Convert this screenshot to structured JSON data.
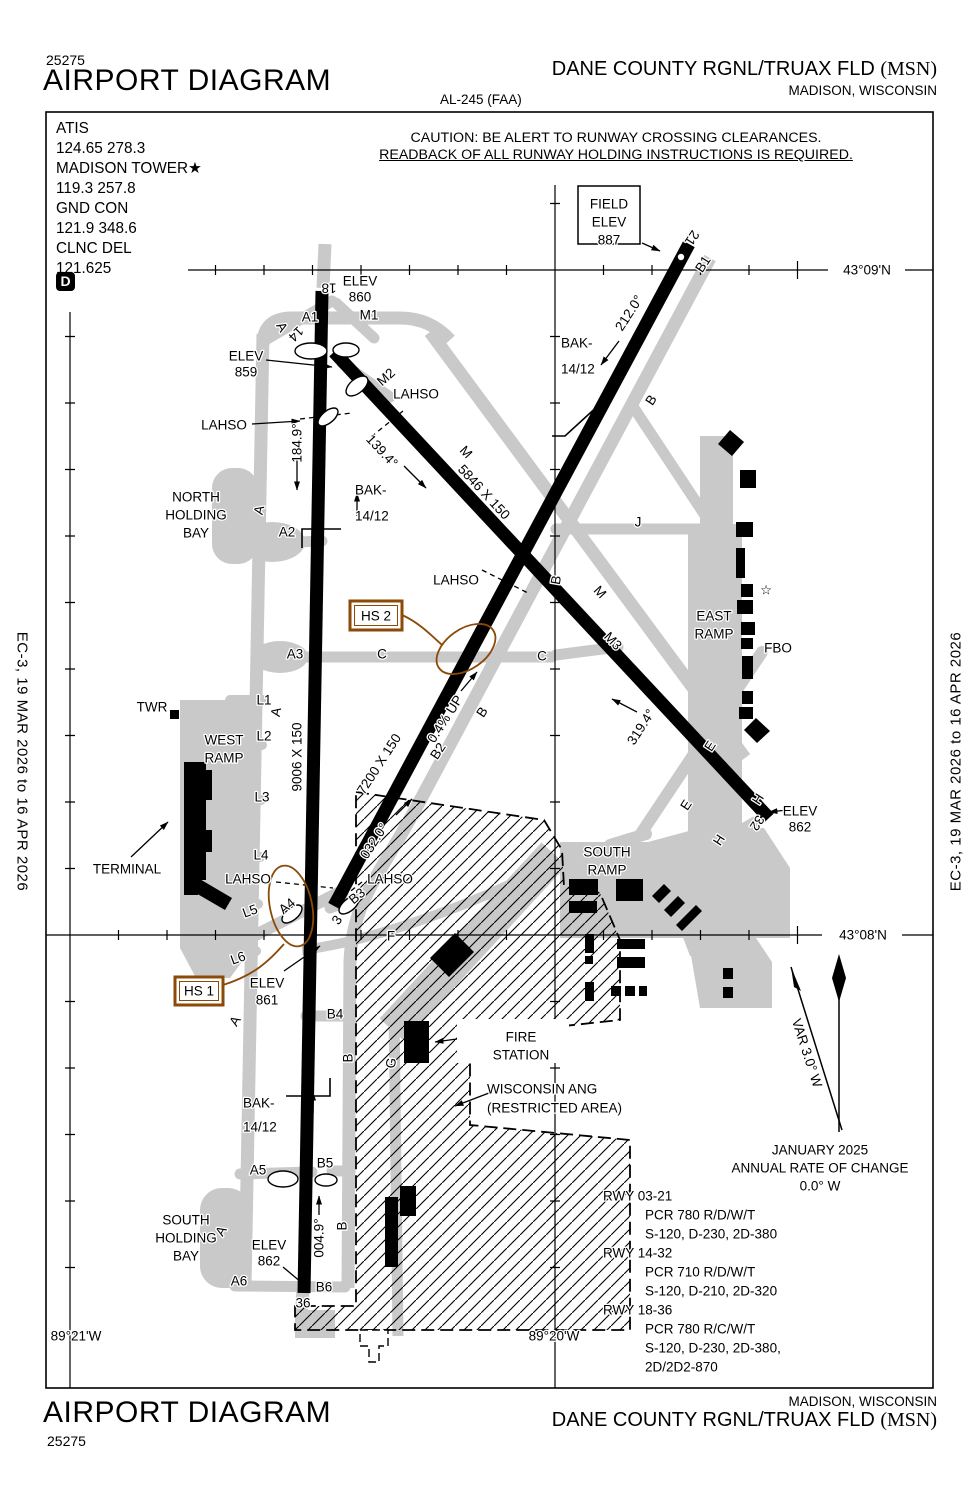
{
  "colors": {
    "hs": "#8b4a08",
    "taxiway": "#c9c9c9"
  },
  "header": {
    "chart_number": "25275",
    "title": "AIRPORT DIAGRAM",
    "chart_code": "AL-245 (FAA)",
    "airport_name": "DANE COUNTY RGNL/TRUAX FLD",
    "airport_ident": "(MSN)",
    "city": "MADISON, WISCONSIN"
  },
  "footer": {
    "chart_number": "25275",
    "title": "AIRPORT DIAGRAM",
    "airport_name": "DANE COUNTY RGNL/TRUAX FLD",
    "airport_ident": "(MSN)",
    "city": "MADISON, WISCONSIN"
  },
  "edge_note": "EC-3,  19 MAR 2026  to  16 APR 2026",
  "caution": {
    "line1": "CAUTION: BE ALERT TO RUNWAY CROSSING CLEARANCES.",
    "line2": "READBACK OF ALL RUNWAY HOLDING INSTRUCTIONS IS REQUIRED."
  },
  "comm": {
    "lines": [
      "ATIS",
      "124.65  278.3",
      "MADISON TOWER★",
      "119.3  257.8",
      "GND CON",
      "121.9  348.6",
      "CLNC DEL",
      "121.625"
    ],
    "d_symbol": "D"
  },
  "map_labels": [
    {
      "n": "field-elev-word1",
      "t": "FIELD",
      "x": 609,
      "y": 204,
      "s": 15
    },
    {
      "n": "field-elev-word2",
      "t": "ELEV",
      "x": 609,
      "y": 222,
      "s": 15
    },
    {
      "n": "field-elev-value",
      "t": "887",
      "x": 609,
      "y": 240,
      "s": 15
    },
    {
      "n": "lat-label-0909",
      "t": "43°09'N",
      "x": 867,
      "y": 270,
      "s": 15
    },
    {
      "n": "lat-label-0908",
      "t": "43°08'N",
      "x": 863,
      "y": 935,
      "s": 15
    },
    {
      "n": "lon-label-8921",
      "t": "89°21'W",
      "x": 76,
      "y": 1336,
      "s": 15
    },
    {
      "n": "lon-label-8920",
      "t": "89°20'W",
      "x": 554,
      "y": 1336,
      "s": 15
    },
    {
      "n": "rwy18-number",
      "t": "18",
      "x": 329,
      "y": 288,
      "r": 180,
      "s": 14
    },
    {
      "n": "elev-860-word",
      "t": "ELEV",
      "x": 360,
      "y": 281
    },
    {
      "n": "elev-860-value",
      "t": "860",
      "x": 360,
      "y": 297
    },
    {
      "n": "twy-a1",
      "t": "A1",
      "x": 310,
      "y": 317
    },
    {
      "n": "twy-m1",
      "t": "M1",
      "x": 369,
      "y": 315
    },
    {
      "n": "twy-a-letter-1",
      "t": "A",
      "x": 282,
      "y": 327,
      "r": 60,
      "s": 12.5
    },
    {
      "n": "rwy14-number",
      "t": "14",
      "x": 296,
      "y": 334,
      "r": 135,
      "s": 14
    },
    {
      "n": "elev-859-word",
      "t": "ELEV",
      "x": 246,
      "y": 356
    },
    {
      "n": "elev-859-value",
      "t": "859",
      "x": 246,
      "y": 372
    },
    {
      "n": "twy-m2",
      "t": "M2",
      "x": 386,
      "y": 377,
      "r": -42
    },
    {
      "n": "lahso-1",
      "t": "LAHSO",
      "x": 416,
      "y": 394
    },
    {
      "n": "lahso-2",
      "t": "LAHSO",
      "x": 224,
      "y": 425
    },
    {
      "n": "hdg-184",
      "t": "184.9°",
      "x": 297,
      "y": 443,
      "r": -90
    },
    {
      "n": "bak-n1a",
      "t": "BAK-",
      "x": 355,
      "y": 490,
      "a": "s"
    },
    {
      "n": "bak-n1b",
      "t": "14/12",
      "x": 355,
      "y": 516,
      "a": "s"
    },
    {
      "n": "dim-5846",
      "t": "5846 X 150",
      "x": 484,
      "y": 492,
      "r": 47
    },
    {
      "n": "hdg-139",
      "t": "139.4°",
      "x": 382,
      "y": 451,
      "r": 47
    },
    {
      "n": "twy-m-letter-1",
      "t": "M",
      "x": 466,
      "y": 452,
      "r": 47
    },
    {
      "n": "twy-m-letter-2",
      "t": "M",
      "x": 600,
      "y": 592,
      "r": 47
    },
    {
      "n": "twy-m3",
      "t": "M3",
      "x": 613,
      "y": 641,
      "r": 47
    },
    {
      "n": "bak-n2a",
      "t": "BAK-",
      "x": 561,
      "y": 343,
      "a": "s"
    },
    {
      "n": "bak-n2b",
      "t": "14/12",
      "x": 561,
      "y": 369,
      "a": "s"
    },
    {
      "n": "hdg-212",
      "t": "212.0°",
      "x": 629,
      "y": 313,
      "r": -57
    },
    {
      "n": "twy-b-letter-1",
      "t": "B",
      "x": 651,
      "y": 400,
      "r": -57
    },
    {
      "n": "twy-b1",
      "t": "B1",
      "x": 703,
      "y": 264,
      "r": -57
    },
    {
      "n": "rwy21-number",
      "t": "21",
      "x": 692,
      "y": 238,
      "r": 123,
      "s": 14
    },
    {
      "n": "north-holding-1",
      "t": "NORTH",
      "x": 196,
      "y": 497
    },
    {
      "n": "north-holding-2",
      "t": "HOLDING",
      "x": 196,
      "y": 515
    },
    {
      "n": "north-holding-3",
      "t": "BAY",
      "x": 196,
      "y": 533
    },
    {
      "n": "twy-a-letter-2",
      "t": "A",
      "x": 259,
      "y": 510,
      "r": -78,
      "s": 12.5
    },
    {
      "n": "twy-a2",
      "t": "A2",
      "x": 287,
      "y": 532
    },
    {
      "n": "hs2-label",
      "t": "HS 2",
      "x": 376,
      "y": 616,
      "c": "hs",
      "s": 14.5
    },
    {
      "n": "twy-a3",
      "t": "A3",
      "x": 295,
      "y": 654
    },
    {
      "n": "twy-c-letter-1",
      "t": "C",
      "x": 382,
      "y": 654
    },
    {
      "n": "twy-c-letter-2",
      "t": "C",
      "x": 542,
      "y": 656
    },
    {
      "n": "lahso-3",
      "t": "LAHSO",
      "x": 456,
      "y": 580
    },
    {
      "n": "twy-b-letter-2",
      "t": "B",
      "x": 556,
      "y": 580,
      "r": -80
    },
    {
      "n": "twy-j",
      "t": "J",
      "x": 638,
      "y": 522
    },
    {
      "n": "east-ramp-1",
      "t": "EAST",
      "x": 714,
      "y": 616,
      "s": 14.5
    },
    {
      "n": "east-ramp-2",
      "t": "RAMP",
      "x": 714,
      "y": 634,
      "s": 14.5
    },
    {
      "n": "beacon-star-icon",
      "t": "☆",
      "x": 766,
      "y": 590,
      "s": 18
    },
    {
      "n": "fbo-label",
      "t": "FBO",
      "x": 778,
      "y": 648,
      "s": 14.5
    },
    {
      "n": "twr-label",
      "t": "TWR",
      "x": 152,
      "y": 707
    },
    {
      "n": "west-ramp-1",
      "t": "WEST",
      "x": 224,
      "y": 740,
      "s": 14.5
    },
    {
      "n": "west-ramp-2",
      "t": "RAMP",
      "x": 224,
      "y": 758,
      "s": 14.5
    },
    {
      "n": "twy-l1",
      "t": "L1",
      "x": 264,
      "y": 700
    },
    {
      "n": "twy-a-letter-3",
      "t": "A",
      "x": 276,
      "y": 712,
      "r": -80,
      "s": 12.5
    },
    {
      "n": "twy-l2",
      "t": "L2",
      "x": 264,
      "y": 736
    },
    {
      "n": "twy-l3",
      "t": "L3",
      "x": 262,
      "y": 797
    },
    {
      "n": "twy-l4",
      "t": "L4",
      "x": 261,
      "y": 855
    },
    {
      "n": "twy-l5",
      "t": "L5",
      "x": 250,
      "y": 911,
      "r": -20
    },
    {
      "n": "twy-l6",
      "t": "L6",
      "x": 238,
      "y": 958,
      "r": -20
    },
    {
      "n": "dim-9006",
      "t": "9006 X 150",
      "x": 297,
      "y": 757,
      "r": -90
    },
    {
      "n": "dim-7200",
      "t": "7200 X 150",
      "x": 379,
      "y": 764,
      "r": -57
    },
    {
      "n": "hdg-032",
      "t": "032.0°",
      "x": 374,
      "y": 841,
      "r": -57
    },
    {
      "n": "grade-note",
      "t": "0.4% UP",
      "x": 445,
      "y": 719,
      "r": -57
    },
    {
      "n": "twy-b-letter-3",
      "t": "B",
      "x": 482,
      "y": 712,
      "r": -57
    },
    {
      "n": "twy-b2",
      "t": "B2",
      "x": 438,
      "y": 751,
      "r": -57
    },
    {
      "n": "hdg-319",
      "t": "319.4°",
      "x": 641,
      "y": 727,
      "r": -57
    },
    {
      "n": "twy-e-letter-1",
      "t": "E",
      "x": 710,
      "y": 746,
      "r": -57
    },
    {
      "n": "twy-e-letter-2",
      "t": "E",
      "x": 686,
      "y": 805,
      "r": -57
    },
    {
      "n": "twy-h-letter-1",
      "t": "H",
      "x": 758,
      "y": 799,
      "r": -57
    },
    {
      "n": "twy-h-letter-2",
      "t": "H",
      "x": 719,
      "y": 840,
      "r": -57
    },
    {
      "n": "rwy32-number",
      "t": "32",
      "x": 757,
      "y": 823,
      "r": 123,
      "s": 14
    },
    {
      "n": "elev-862-word",
      "t": "ELEV",
      "x": 800,
      "y": 811
    },
    {
      "n": "elev-862-value",
      "t": "862",
      "x": 800,
      "y": 827
    },
    {
      "n": "terminal-label",
      "t": "TERMINAL",
      "x": 127,
      "y": 869
    },
    {
      "n": "lahso-4",
      "t": "LAHSO",
      "x": 248,
      "y": 879
    },
    {
      "n": "lahso-5",
      "t": "LAHSO",
      "x": 390,
      "y": 879
    },
    {
      "n": "twy-a4",
      "t": "A4",
      "x": 287,
      "y": 906,
      "r": -40
    },
    {
      "n": "twy-b3",
      "t": "B3",
      "x": 357,
      "y": 896,
      "r": -40
    },
    {
      "n": "rwy3-number",
      "t": "3",
      "x": 337,
      "y": 920,
      "r": -55,
      "s": 14
    },
    {
      "n": "twy-f",
      "t": "F",
      "x": 391,
      "y": 936
    },
    {
      "n": "south-ramp-1",
      "t": "SOUTH",
      "x": 607,
      "y": 852,
      "s": 14.5
    },
    {
      "n": "south-ramp-2",
      "t": "RAMP",
      "x": 607,
      "y": 870,
      "s": 14.5
    },
    {
      "n": "hs1-label",
      "t": "HS 1",
      "x": 199,
      "y": 991,
      "c": "hs",
      "s": 14.5
    },
    {
      "n": "elev-861-word",
      "t": "ELEV",
      "x": 267,
      "y": 983
    },
    {
      "n": "elev-861-value",
      "t": "861",
      "x": 267,
      "y": 1000
    },
    {
      "n": "twy-b4",
      "t": "B4",
      "x": 335,
      "y": 1014
    },
    {
      "n": "twy-a-letter-4",
      "t": "A",
      "x": 235,
      "y": 1021,
      "r": -60,
      "s": 12.5
    },
    {
      "n": "twy-b-letter-4",
      "t": "B",
      "x": 348,
      "y": 1058,
      "r": -90
    },
    {
      "n": "twy-g",
      "t": "G",
      "x": 391,
      "y": 1063,
      "r": -80
    },
    {
      "n": "fire-station-1",
      "t": "FIRE",
      "x": 521,
      "y": 1037,
      "s": 14.5
    },
    {
      "n": "fire-station-2",
      "t": "STATION",
      "x": 521,
      "y": 1055,
      "s": 14.5
    },
    {
      "n": "ang-1",
      "t": "WISCONSIN  ANG",
      "x": 487,
      "y": 1089,
      "a": "s",
      "s": 14.5
    },
    {
      "n": "ang-2",
      "t": "(RESTRICTED AREA)",
      "x": 487,
      "y": 1108,
      "a": "s",
      "s": 14.5
    },
    {
      "n": "bak-s1a",
      "t": "BAK-",
      "x": 243,
      "y": 1103,
      "a": "s"
    },
    {
      "n": "bak-s1b",
      "t": "14/12",
      "x": 243,
      "y": 1127,
      "a": "s"
    },
    {
      "n": "twy-a5",
      "t": "A5",
      "x": 258,
      "y": 1170
    },
    {
      "n": "twy-b5",
      "t": "B5",
      "x": 325,
      "y": 1163
    },
    {
      "n": "hdg-004",
      "t": "004.9°",
      "x": 319,
      "y": 1238,
      "r": -90
    },
    {
      "n": "twy-b-letter-5",
      "t": "B",
      "x": 342,
      "y": 1226,
      "r": -90
    },
    {
      "n": "twy-a-letter-5",
      "t": "A",
      "x": 221,
      "y": 1231,
      "r": -60,
      "s": 12.5
    },
    {
      "n": "south-holding-1",
      "t": "SOUTH",
      "x": 186,
      "y": 1220
    },
    {
      "n": "south-holding-2",
      "t": "HOLDING",
      "x": 186,
      "y": 1238
    },
    {
      "n": "south-holding-3",
      "t": "BAY",
      "x": 186,
      "y": 1256
    },
    {
      "n": "elev-862b-word",
      "t": "ELEV",
      "x": 269,
      "y": 1245
    },
    {
      "n": "elev-862b-value",
      "t": "862",
      "x": 269,
      "y": 1261
    },
    {
      "n": "twy-a6",
      "t": "A6",
      "x": 239,
      "y": 1281
    },
    {
      "n": "twy-b6",
      "t": "B6",
      "x": 324,
      "y": 1287
    },
    {
      "n": "rwy36-number",
      "t": "36",
      "x": 303,
      "y": 1303,
      "s": 14
    },
    {
      "n": "var-label",
      "t": "VAR 3.0° W",
      "x": 807,
      "y": 1053,
      "r": 72,
      "s": 13
    },
    {
      "n": "roc-1",
      "t": "JANUARY 2025",
      "x": 820,
      "y": 1150,
      "s": 15
    },
    {
      "n": "roc-2",
      "t": "ANNUAL RATE OF CHANGE",
      "x": 820,
      "y": 1168,
      "s": 15
    },
    {
      "n": "roc-3",
      "t": "0.0° W",
      "x": 820,
      "y": 1186,
      "s": 15
    },
    {
      "n": "rwydata-1",
      "t": "RWY 03-21",
      "x": 603,
      "y": 1196,
      "a": "s",
      "s": 15
    },
    {
      "n": "rwydata-2",
      "t": "PCR 780 R/D/W/T",
      "x": 645,
      "y": 1215,
      "a": "s",
      "s": 15
    },
    {
      "n": "rwydata-3",
      "t": "S-120, D-230, 2D-380",
      "x": 645,
      "y": 1234,
      "a": "s",
      "s": 15
    },
    {
      "n": "rwydata-4",
      "t": "RWY 14-32",
      "x": 603,
      "y": 1253,
      "a": "s",
      "s": 15
    },
    {
      "n": "rwydata-5",
      "t": "PCR 710 R/D/W/T",
      "x": 645,
      "y": 1272,
      "a": "s",
      "s": 15
    },
    {
      "n": "rwydata-6",
      "t": "S-120, D-210, 2D-320",
      "x": 645,
      "y": 1291,
      "a": "s",
      "s": 15
    },
    {
      "n": "rwydata-7",
      "t": "RWY 18-36",
      "x": 603,
      "y": 1310,
      "a": "s",
      "s": 15
    },
    {
      "n": "rwydata-8",
      "t": "PCR 780 R/C/W/T",
      "x": 645,
      "y": 1329,
      "a": "s",
      "s": 15
    },
    {
      "n": "rwydata-9",
      "t": "S-120, D-230, 2D-380,",
      "x": 645,
      "y": 1348,
      "a": "s",
      "s": 15
    },
    {
      "n": "rwydata-10",
      "t": "2D/2D2-870",
      "x": 645,
      "y": 1367,
      "a": "s",
      "s": 15
    }
  ]
}
